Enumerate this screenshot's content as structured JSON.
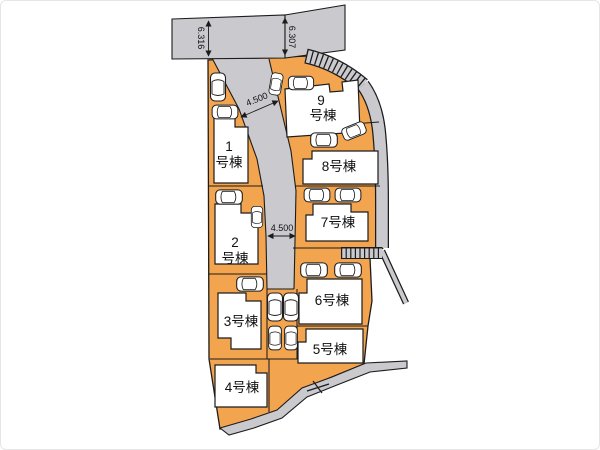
{
  "colors": {
    "lot_fill": "#F3A44F",
    "road_fill": "#C9C9CE",
    "building_fill": "#FFFFFF",
    "line_color": "#1C1C1C",
    "text_color": "#111111"
  },
  "lots": [
    {
      "name": "1号棟",
      "lines": [
        "1",
        "号棟"
      ]
    },
    {
      "name": "2号棟",
      "lines": [
        "2",
        "号棟"
      ]
    },
    {
      "name": "3号棟",
      "lines": [
        "3号棟"
      ]
    },
    {
      "name": "4号棟",
      "lines": [
        "4号棟"
      ]
    },
    {
      "name": "5号棟",
      "lines": [
        "5号棟"
      ]
    },
    {
      "name": "6号棟",
      "lines": [
        "6号棟"
      ]
    },
    {
      "name": "7号棟",
      "lines": [
        "7号棟"
      ]
    },
    {
      "name": "8号棟",
      "lines": [
        "8号棟"
      ]
    },
    {
      "name": "9号棟",
      "lines": [
        "9",
        "号棟"
      ]
    }
  ],
  "dimensions": {
    "top_road_left_width": "6.316",
    "top_road_right_width": "6.307",
    "center_road_width_upper": "4.500",
    "center_road_width_lower": "4.500"
  }
}
